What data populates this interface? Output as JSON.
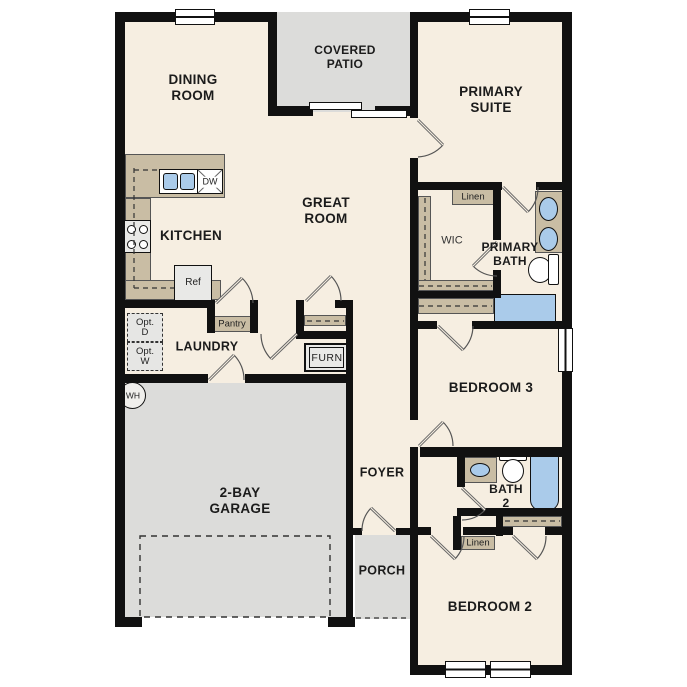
{
  "floor_plan": {
    "rooms": {
      "dining_room": "DINING\nROOM",
      "covered_patio": "COVERED\nPATIO",
      "primary_suite": "PRIMARY\nSUITE",
      "kitchen": "KITCHEN",
      "great_room": "GREAT\nROOM",
      "laundry": "LAUNDRY",
      "wic": "WIC",
      "primary_bath": "PRIMARY\nBATH",
      "bedroom_3": "BEDROOM 3",
      "garage": "2-BAY\nGARAGE",
      "foyer": "FOYER",
      "bath_2": "BATH\n2",
      "porch": "PORCH",
      "bedroom_2": "BEDROOM 2"
    },
    "fixtures": {
      "pantry": "Pantry",
      "linen_upper": "Linen",
      "linen_lower": "Linen",
      "furnace": "FURN",
      "refrigerator": "Ref",
      "dishwasher": "DW",
      "water_heater": "WH",
      "optional_dryer": "Opt.\nD",
      "optional_washer": "Opt.\nW"
    },
    "colors": {
      "wall": "#111111",
      "floor": "#f6eee1",
      "outdoor_concrete": "#dcdcda",
      "cabinetry": "#c9bda4",
      "plumbing_blue": "#aacbea"
    }
  }
}
